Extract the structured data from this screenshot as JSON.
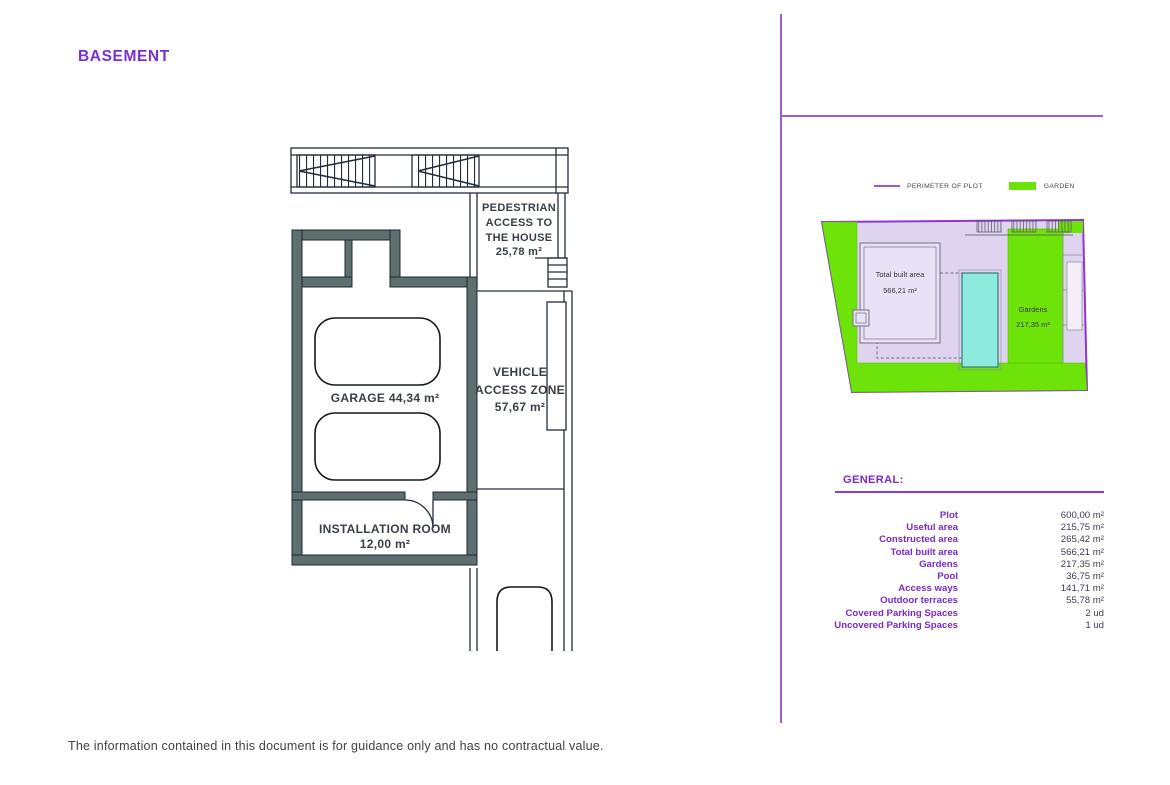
{
  "page": {
    "title": "BASEMENT",
    "disclaimer": "The information contained in this document is for guidance only and has no contractual value."
  },
  "floor_plan": {
    "pedestrian": [
      "PEDESTRIAN",
      "ACCESS TO",
      "THE HOUSE",
      "25,78 m²"
    ],
    "garage": "GARAGE 44,34 m²",
    "vehicle": [
      "VEHICLE",
      "ACCESS ZONE",
      "57,67 m²"
    ],
    "installation": [
      "INSTALLATION ROOM",
      "12,00 m²"
    ]
  },
  "site_plan": {
    "legend": {
      "perimeter_label": "PERIMETER OF PLOT",
      "garden_label": "GARDEN"
    },
    "built_area_line1": "Total built area",
    "built_area_line2": "566,21 m²",
    "gardens_line1": "Gardens",
    "gardens_line2": "217,35 m²",
    "colors": {
      "perimeter": "#9B59D6",
      "garden": "#6EE30A",
      "plot_fill": "#DFD4EF",
      "pool": "#8DEBDE",
      "accent_purple": "#7B2FD6"
    }
  },
  "general": {
    "heading": "GENERAL:",
    "rows": [
      {
        "label": "Plot",
        "value": "600,00 m²"
      },
      {
        "label": "Useful area",
        "value": "215,75 m²"
      },
      {
        "label": "Constructed area",
        "value": "265,42 m²"
      },
      {
        "label": "Total built area",
        "value": "566,21 m²"
      },
      {
        "label": "Gardens",
        "value": "217,35 m²"
      },
      {
        "label": "Pool",
        "value": "36,75 m²"
      },
      {
        "label": "Access ways",
        "value": "141,71 m²"
      },
      {
        "label": "Outdoor terraces",
        "value": "55,78 m²"
      },
      {
        "label": "Covered Parking Spaces",
        "value": "2 ud"
      },
      {
        "label": "Uncovered Parking Spaces",
        "value": "1 ud"
      }
    ]
  }
}
